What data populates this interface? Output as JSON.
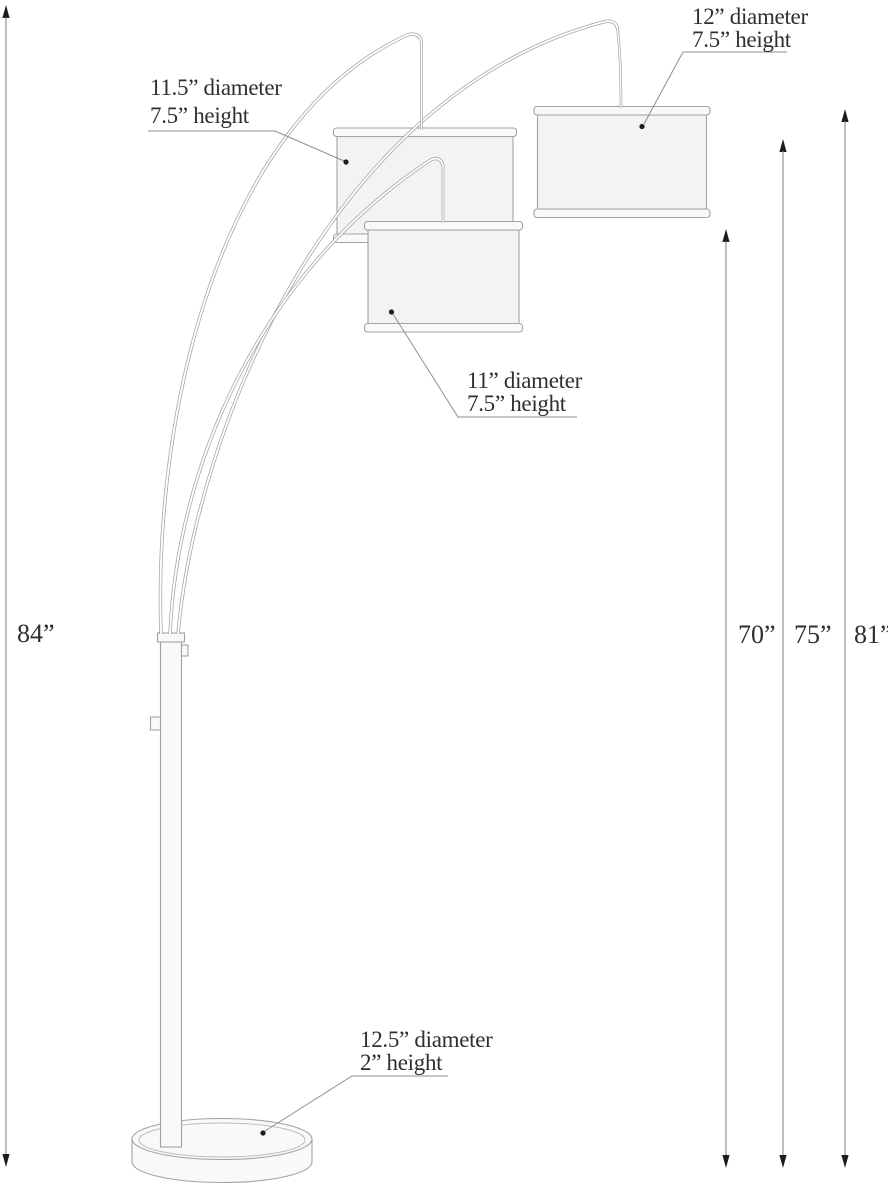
{
  "diagram_title": "arc floor lamp dimension drawing",
  "labels": {
    "shade_top_left": {
      "line1": "11.5” diameter",
      "line2": "7.5” height"
    },
    "shade_top_right": {
      "line1": "12” diameter",
      "line2": "7.5” height"
    },
    "shade_middle": {
      "line1": "11” diameter",
      "line2": "7.5” height"
    },
    "base": {
      "line1": "12.5” diameter",
      "line2": "2” height"
    }
  },
  "dimensions": {
    "overall_height": "84”",
    "shade_heights": [
      "70”",
      "75”",
      "81”"
    ]
  },
  "colors": {
    "line": "#a3a3a3",
    "leader": "#8f8f8f",
    "dimension": "#7d7d7d",
    "arrow": "#1d1d1d",
    "text": "#2f2f2f",
    "shade-fill": "#f3f3f3",
    "rim-fill": "#f9f9f9",
    "background": "#ffffff"
  }
}
